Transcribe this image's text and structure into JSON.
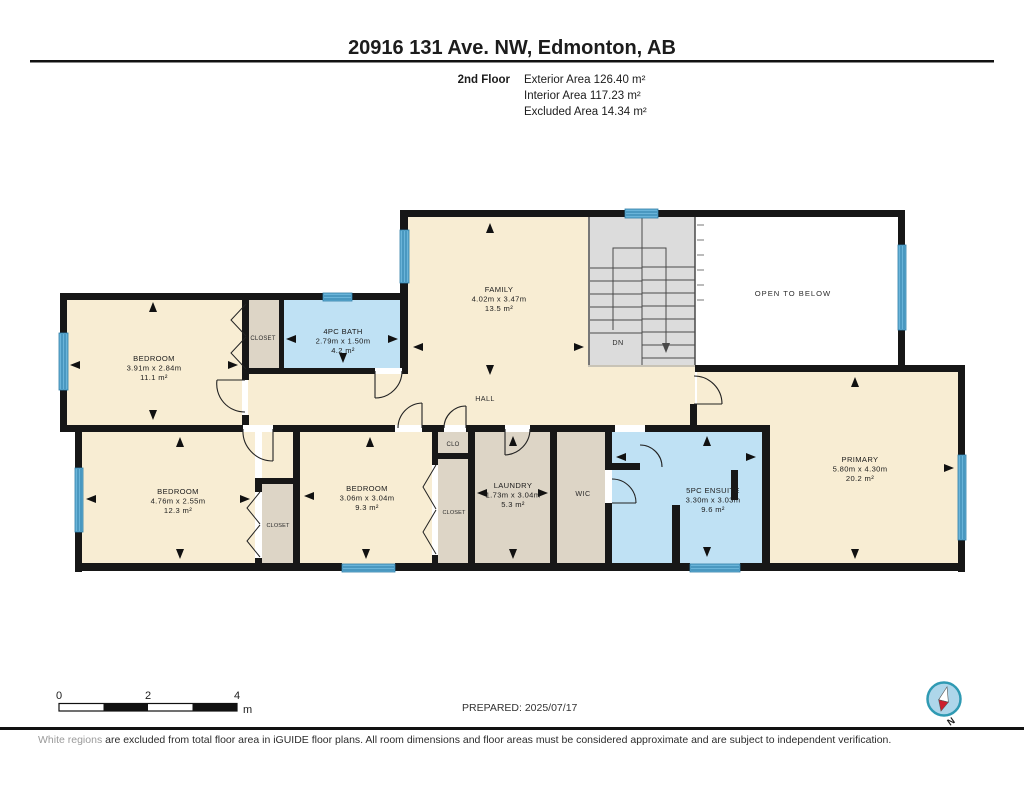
{
  "header": {
    "title": "20916 131 Ave. NW, Edmonton, AB",
    "floor_label": "2nd Floor",
    "stats": {
      "exterior": "Exterior Area 126.40 m²",
      "interior": "Interior Area 117.23 m²",
      "excluded": "Excluded Area 14.34 m²"
    }
  },
  "rooms": [
    {
      "name": "BEDROOM",
      "dims": "3.91m x 2.84m",
      "area": "11.1 m²"
    },
    {
      "name": "4PC BATH",
      "dims": "2.79m x 1.50m",
      "area": "4.2 m²"
    },
    {
      "name": "FAMILY",
      "dims": "4.02m x 3.47m",
      "area": "13.5 m²"
    },
    {
      "name": "BEDROOM",
      "dims": "4.76m x 2.55m",
      "area": "12.3 m²"
    },
    {
      "name": "BEDROOM",
      "dims": "3.06m x 3.04m",
      "area": "9.3 m²"
    },
    {
      "name": "LAUNDRY",
      "dims": "1.73m x 3.04m",
      "area": "5.3 m²"
    },
    {
      "name": "5PC ENSUITE",
      "dims": "3.30m x 3.03m",
      "area": "9.6 m²"
    },
    {
      "name": "PRIMARY",
      "dims": "5.80m x 4.30m",
      "area": "20.2 m²"
    }
  ],
  "labels": {
    "closet": "CLOSET",
    "clo": "CLO",
    "wic": "WIC",
    "hall": "HALL",
    "dn": "DN",
    "open_to_below": "OPEN TO BELOW"
  },
  "scale_bar": {
    "tick0": "0",
    "tick2": "2",
    "tick4": "4",
    "unit": "m"
  },
  "footer": {
    "prepared": "PREPARED: 2025/07/17",
    "disclaimer_lead": "White regions",
    "disclaimer_rest": " are excluded from total floor area in iGUIDE floor plans. All room dimensions and floor areas must be considered approximate and are subject to independent verification.",
    "compass_north": "N"
  },
  "colors": {
    "room_floor": "#f8edd3",
    "bath_floor": "#bfe1f4",
    "closet_floor": "#ddd5c6",
    "stairs_floor": "#dcdcdc",
    "wall": "#171717",
    "window": "#6ab4d9",
    "compass_ring": "#2f9ab3",
    "compass_fill": "#aed6ea",
    "compass_needle": "#cc1f2d"
  }
}
